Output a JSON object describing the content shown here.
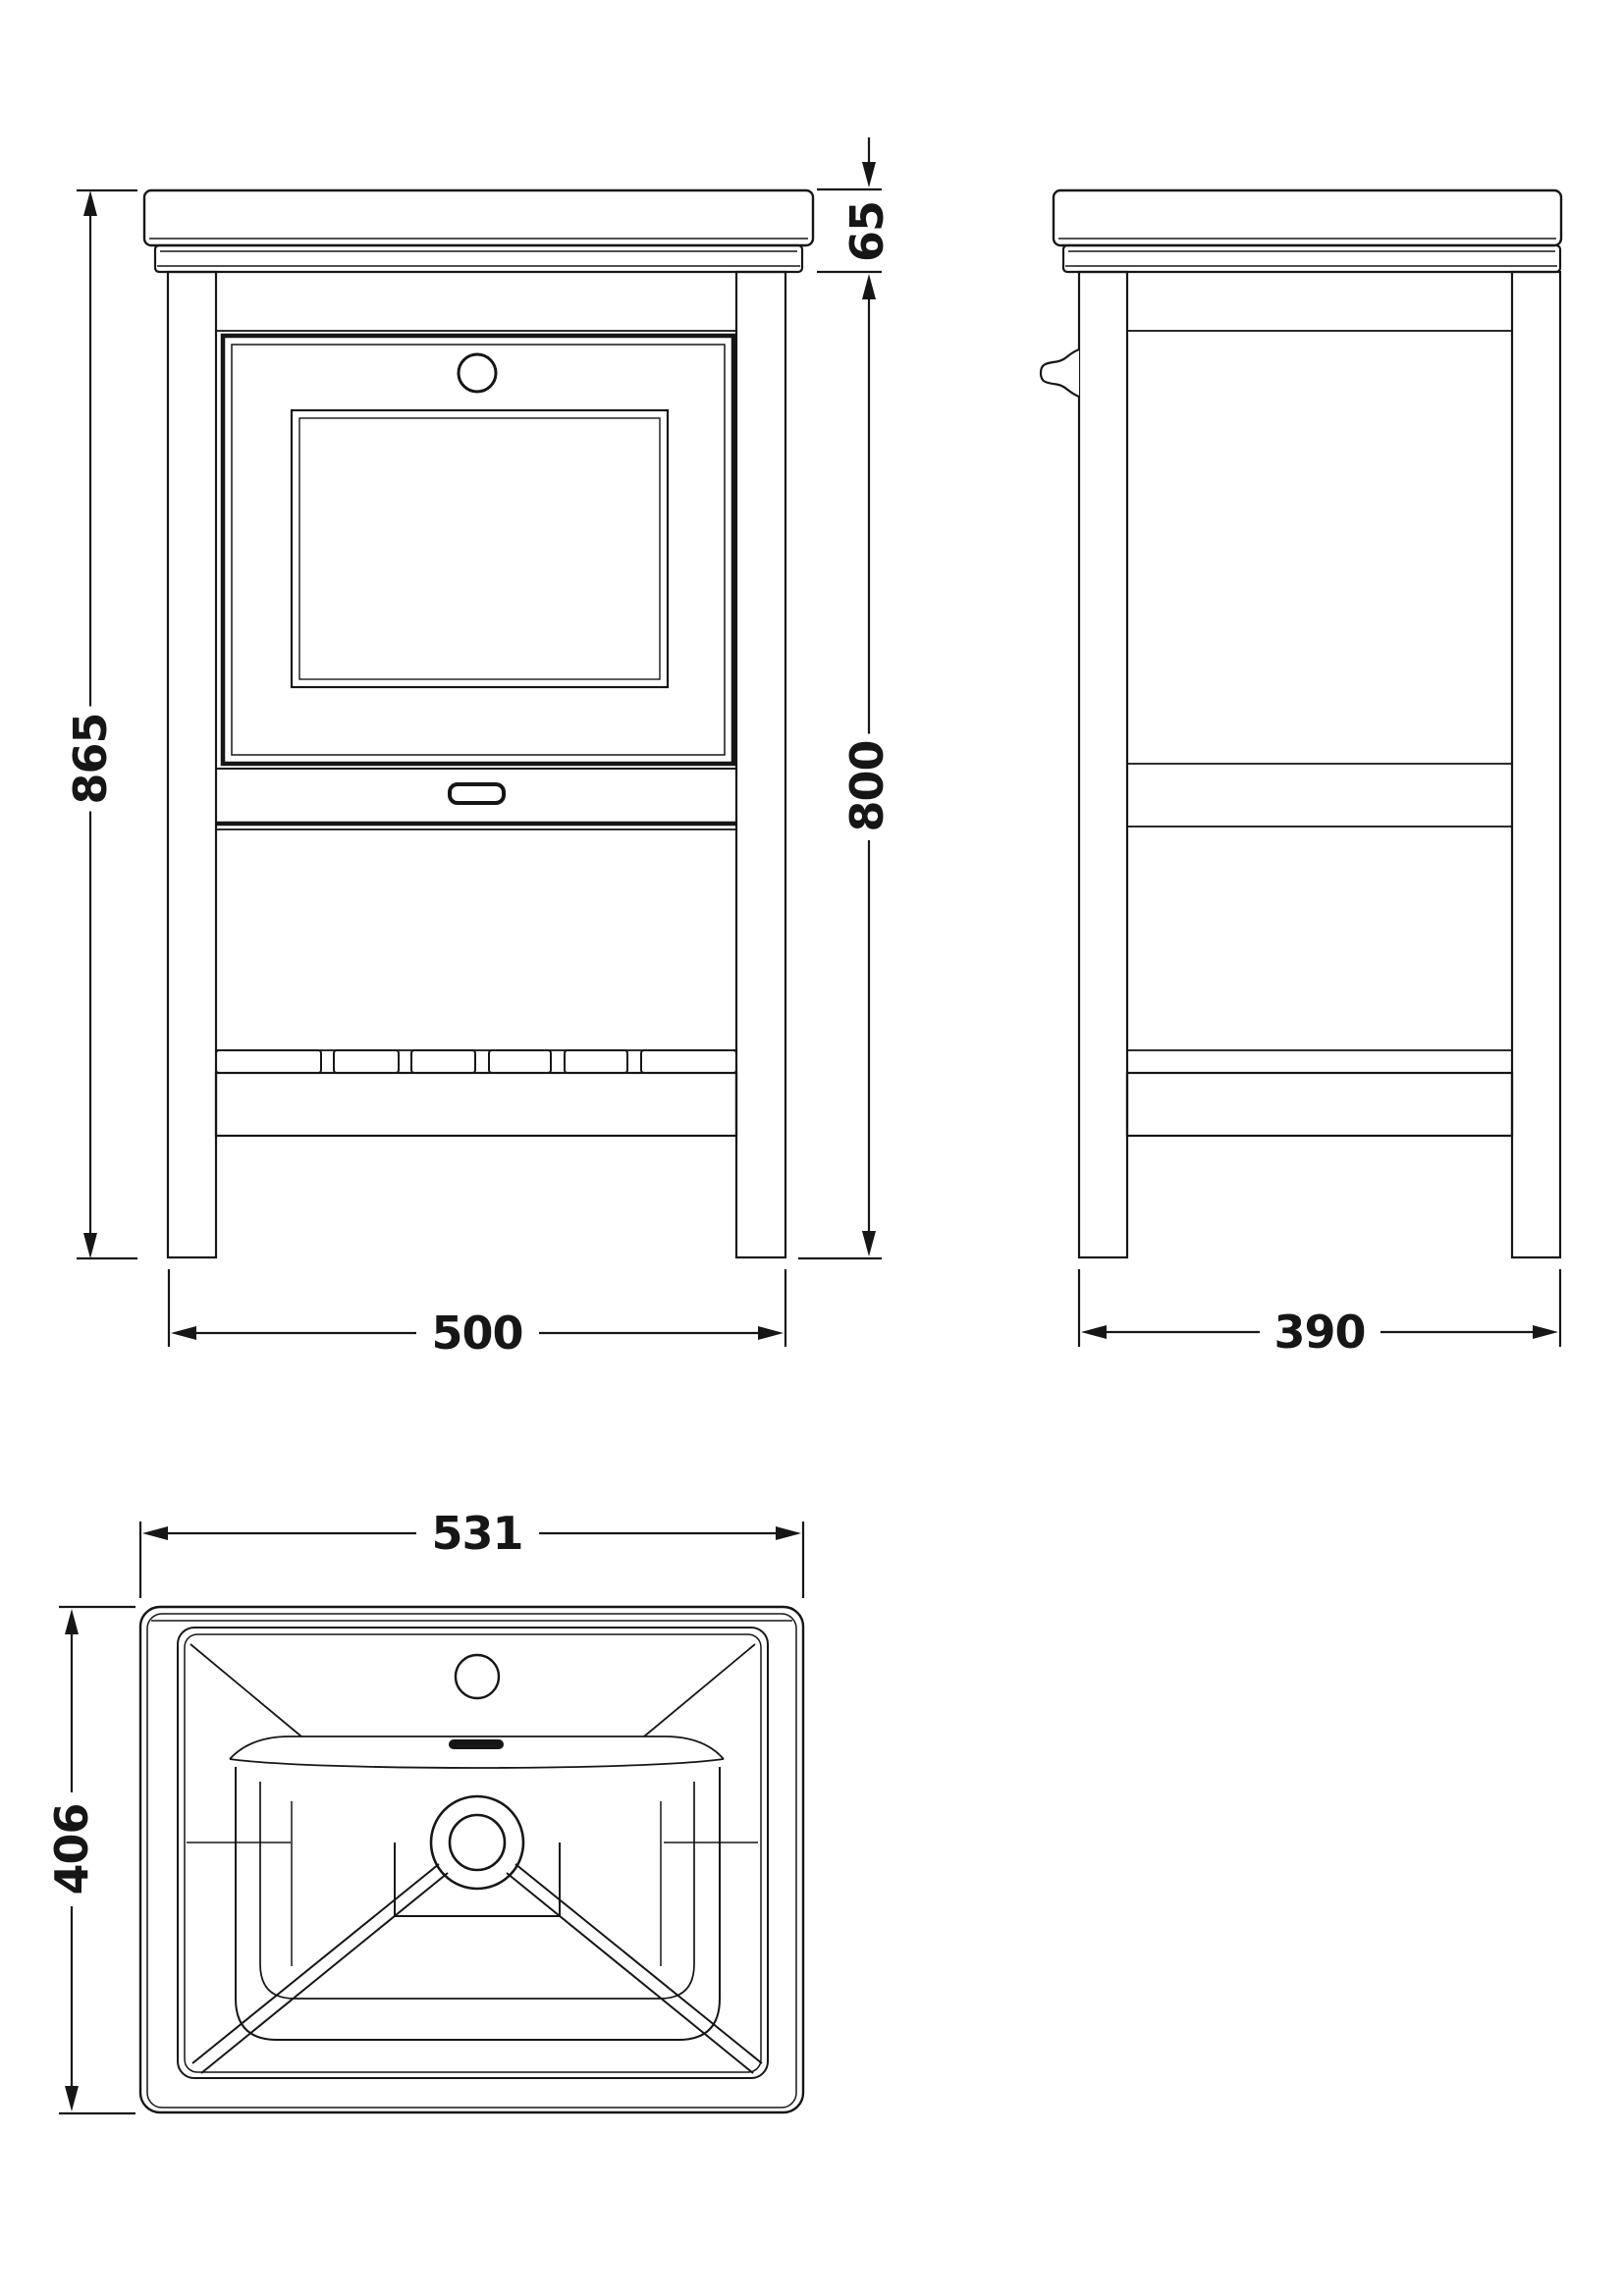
{
  "drawing": {
    "background_color": "#ffffff",
    "line_color": "#161616",
    "front_view": {
      "overall_height": "865",
      "worktop_height": "65",
      "cabinet_height": "800",
      "overall_width": "500"
    },
    "side_view": {
      "overall_depth": "390"
    },
    "plan_view": {
      "basin_width": "531",
      "basin_depth": "406"
    }
  }
}
